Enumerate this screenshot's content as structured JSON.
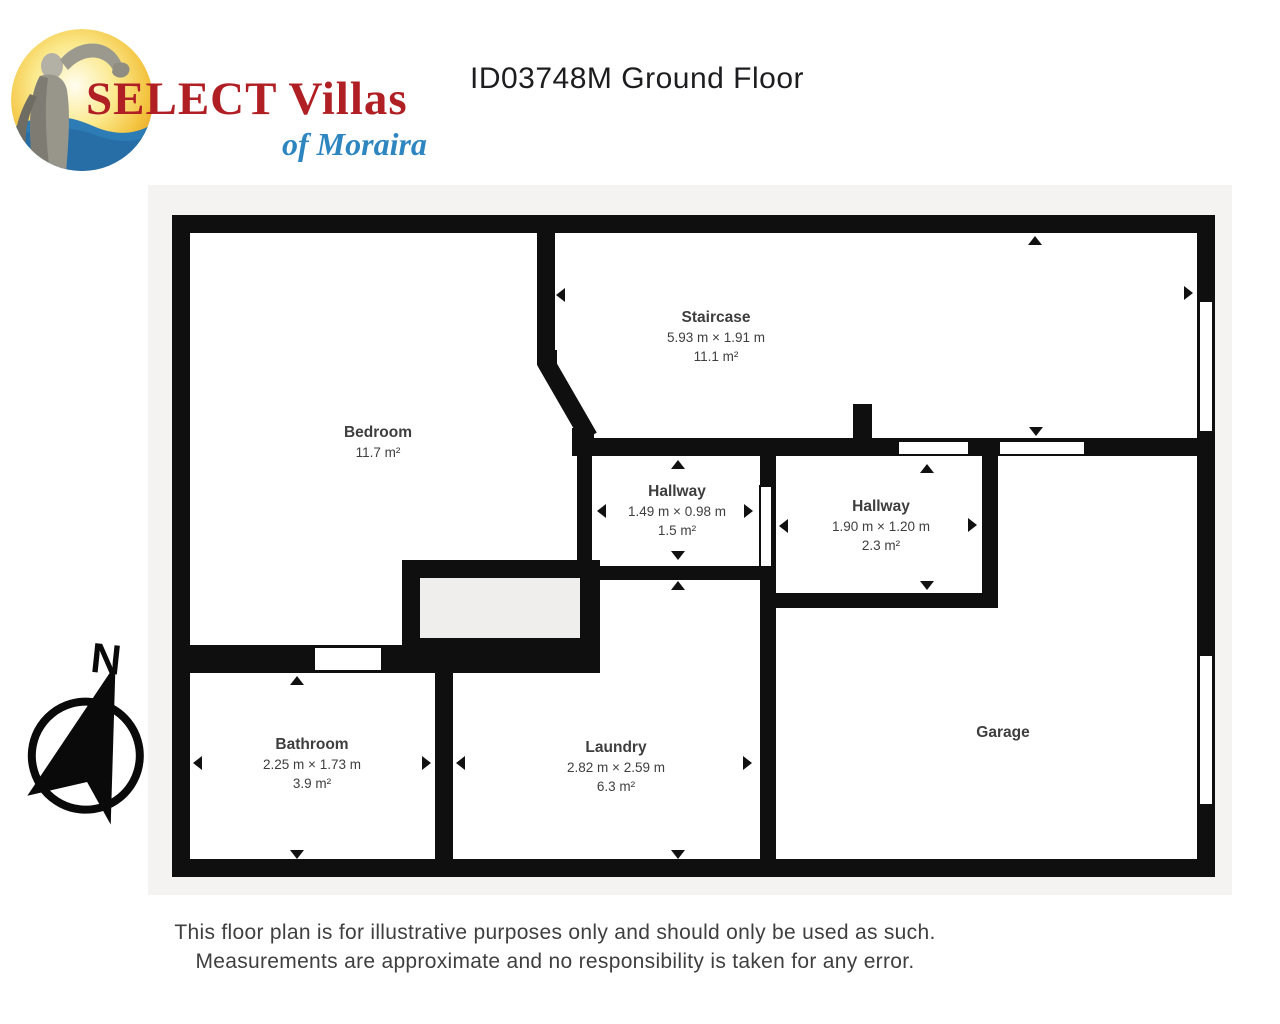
{
  "header": {
    "logo": {
      "line1": "SELECT Villas",
      "line2": "of Moraira"
    },
    "title": "ID03748M Ground Floor"
  },
  "plan": {
    "compass_label": "N",
    "rooms": [
      {
        "name": "Bedroom",
        "area": "11.7 m²"
      },
      {
        "name": "Staircase",
        "dims": "5.93 m × 1.91 m",
        "area": "11.1 m²"
      },
      {
        "name": "Hallway",
        "dims": "1.49 m × 0.98 m",
        "area": "1.5 m²"
      },
      {
        "name": "Hallway",
        "dims": "1.90 m × 1.20 m",
        "area": "2.3 m²"
      },
      {
        "name": "Bathroom",
        "dims": "2.25 m × 1.73 m",
        "area": "3.9 m²"
      },
      {
        "name": "Laundry",
        "dims": "2.82 m × 2.59 m",
        "area": "6.3 m²"
      },
      {
        "name": "Garage"
      }
    ]
  },
  "footer": {
    "line1": "This floor plan is for illustrative purposes only and should only be used as such.",
    "line2": "Measurements are approximate and no responsibility is taken for any error."
  },
  "colors": {
    "wall": "#0f0f0f",
    "plan_background": "#f4f3f1",
    "room_fill": "#ffffff",
    "label_text": "#3e3e3e",
    "logo_red": "#b01f24",
    "logo_blue": "#2e86c0",
    "title_text": "#1d1d1f"
  }
}
